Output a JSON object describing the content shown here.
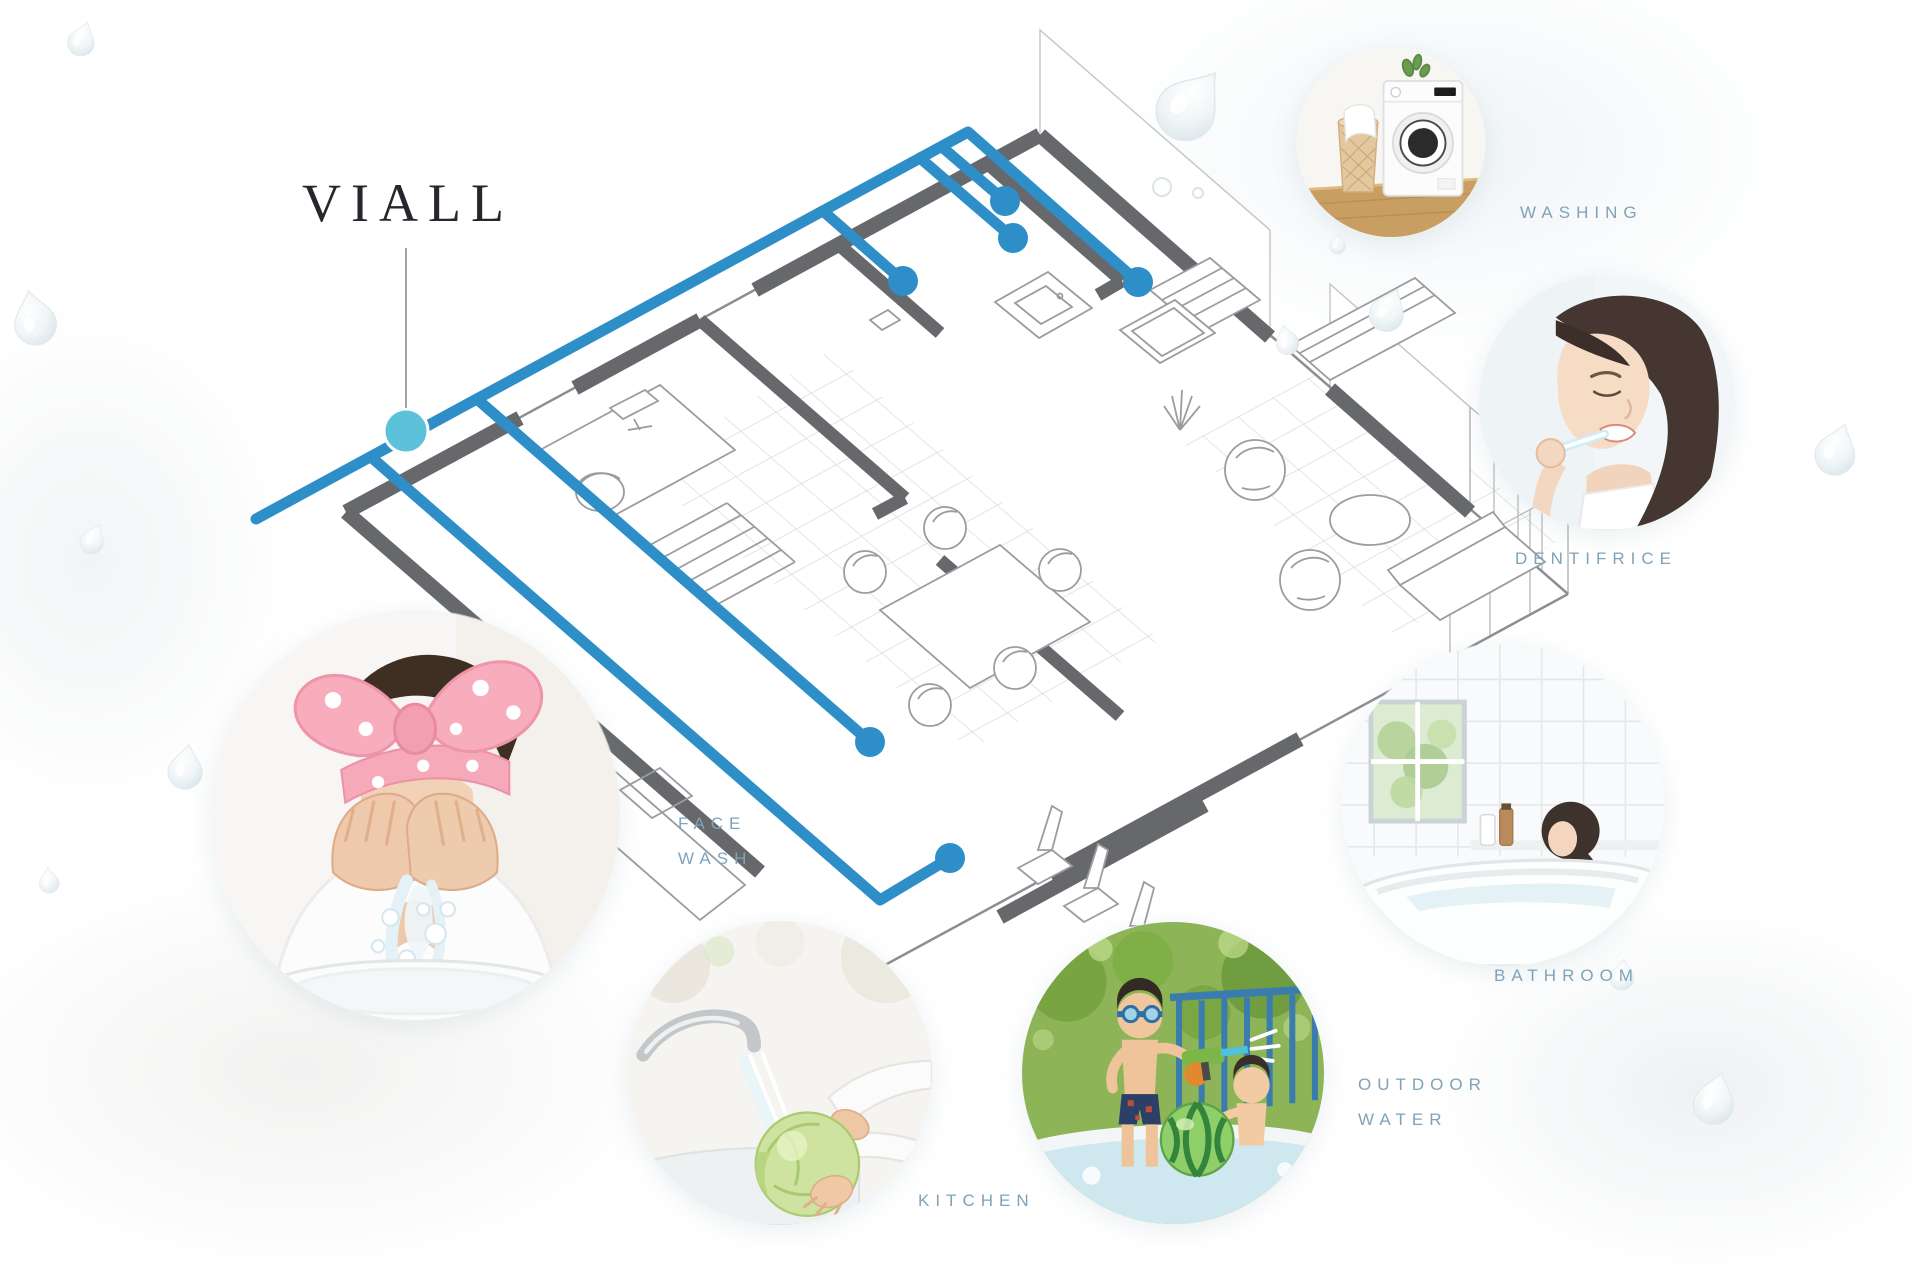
{
  "brand": {
    "name": "VIALL"
  },
  "callouts": {
    "washing": {
      "label": "WASHING"
    },
    "dentifrice": {
      "label": "DENTIFRICE"
    },
    "bathroom": {
      "label": "BATHROOM"
    },
    "outdoor_water": {
      "line1": "OUTDOOR",
      "line2": "WATER"
    },
    "kitchen": {
      "label": "KITCHEN"
    },
    "face_wash": {
      "line1": "FACE",
      "line2": "WASH"
    }
  },
  "photos": {
    "washing": "washing machine with laundry basket",
    "dentifrice": "woman brushing her teeth",
    "bathroom": "woman relaxing in a white bathtub",
    "outdoor_water": "children playing with water gun and watermelon ball in pool",
    "kitchen": "hands rinsing lettuce under running tap",
    "face_wash": "woman in pink bow headband splashing water on her face"
  },
  "colors": {
    "pipe_blue": "#2E8FC8",
    "supply_dot_cyan": "#5BC2DA",
    "wall_gray": "#67686B",
    "wireframe_gray": "#9B9CA0",
    "label_text": "#7FA3B8",
    "brand_text": "#26262D"
  },
  "diagram": {
    "type": "isometric floor plan with whole-house water supply pipes",
    "outlets": [
      "washing",
      "dentifrice",
      "bathroom",
      "kitchen",
      "outdoor_water",
      "face_wash"
    ]
  }
}
